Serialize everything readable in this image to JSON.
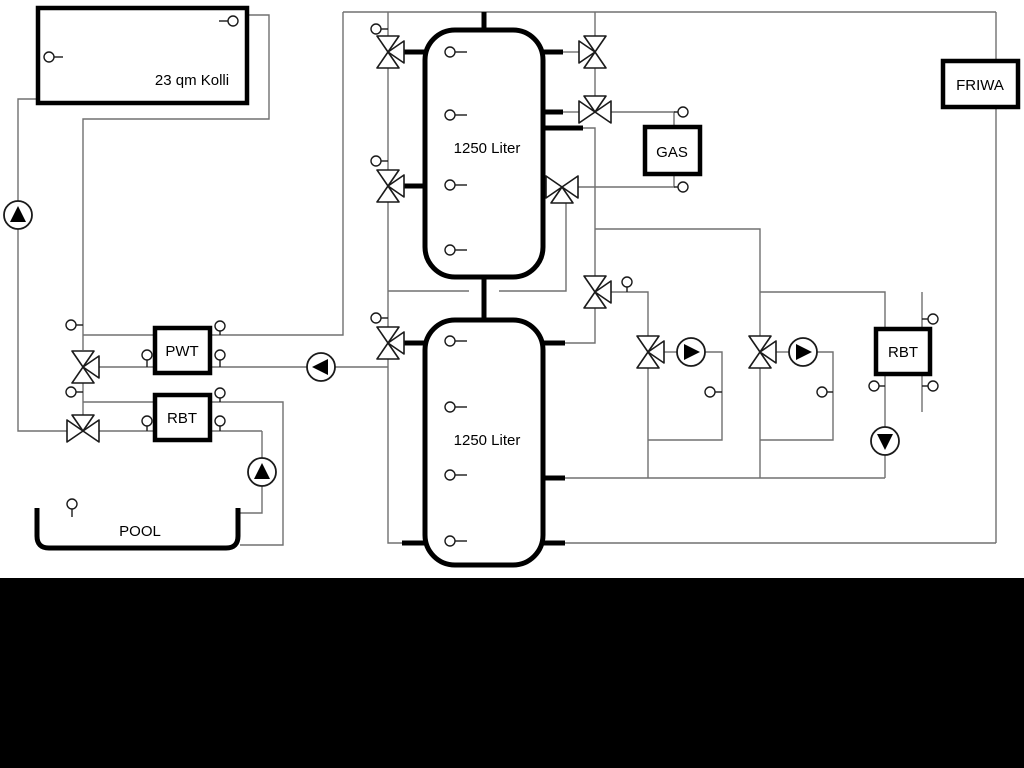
{
  "diagram": {
    "components": {
      "collector": {
        "label": "23 qm Kolli"
      },
      "tank_top": {
        "label": "1250 Liter"
      },
      "tank_bottom": {
        "label": "1250 Liter"
      },
      "pwt": {
        "label": "PWT"
      },
      "rbt_left": {
        "label": "RBT"
      },
      "gas": {
        "label": "GAS"
      },
      "friwa": {
        "label": "FRIWA"
      },
      "rbt_right": {
        "label": "RBT"
      },
      "pool": {
        "label": "POOL"
      }
    },
    "colors": {
      "pipe": "#707070",
      "outline": "#000000",
      "background": "#ffffff",
      "bottom_bar": "#000000"
    }
  }
}
